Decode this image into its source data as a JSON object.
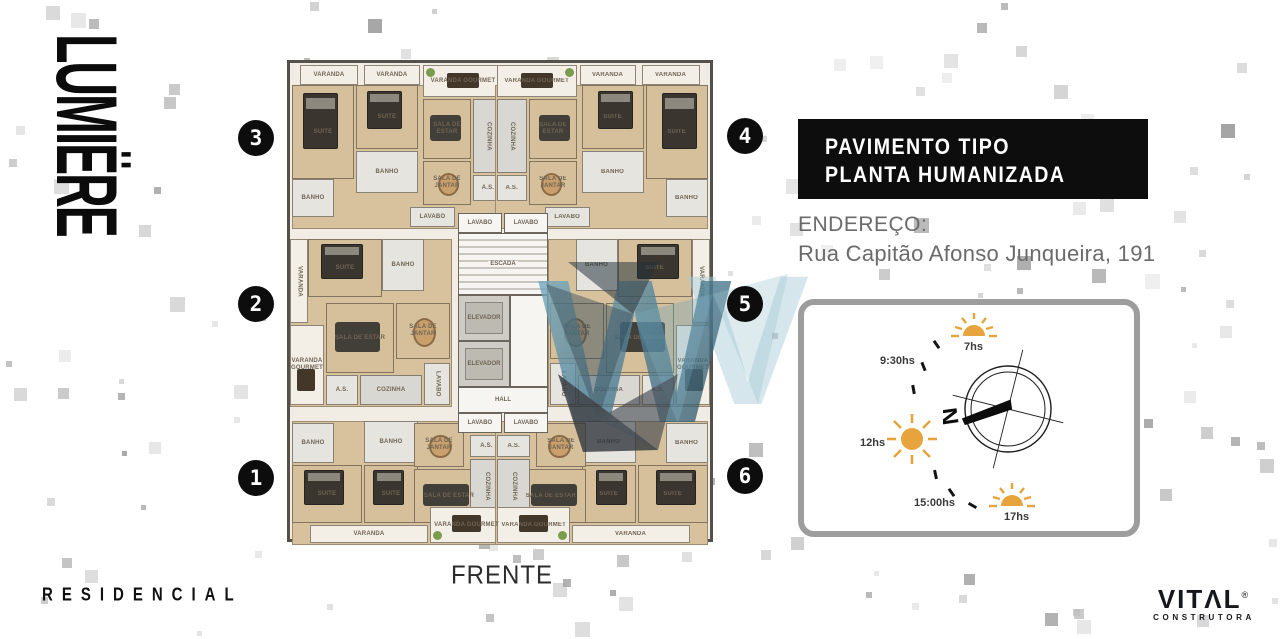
{
  "brand": {
    "name": "LUMIËRE",
    "residencial": "RESIDENCIAL"
  },
  "title_box": {
    "line1": "PAVIMENTO TIPO",
    "line2": "PLANTA HUMANIZADA"
  },
  "address": {
    "label": "ENDEREÇO:",
    "value": "Rua Capitão Afonso Junqueira, 191"
  },
  "sun_diagram": {
    "sun_7": "7hs",
    "sun_930": "9:30hs",
    "sun_12": "12hs",
    "sun_1500": "15:00hs",
    "sun_17": "17hs",
    "north": "N",
    "sun_color": "#E8A43C"
  },
  "plan": {
    "front": "FRENTE",
    "units": [
      "1",
      "2",
      "3",
      "4",
      "5",
      "6"
    ],
    "rooms": {
      "varanda": "VARANDA",
      "varanda_gourmet": "VARANDA GOURMET",
      "suite": "SUITE",
      "banho": "BANHO",
      "sala_estar": "SALA DE ESTAR",
      "sala_jantar": "SALA DE JANTAR",
      "cozinha": "COZINHA",
      "as": "A.S.",
      "lavabo": "LAVABO",
      "escada": "ESCADA",
      "elevador": "ELEVADOR",
      "hall": "HALL"
    }
  },
  "developer": {
    "name_display": "VITΛL",
    "registered": "®",
    "subtitle": "CONSTRUTORA"
  },
  "colors": {
    "box_black": "#0D0D0D",
    "text_gray": "#6A6A6A",
    "floor_beige": "#D8C29D",
    "sun_orange": "#E8A43C",
    "watermark_blue": "#5E93AB",
    "panel_border": "#9D9D9D"
  }
}
